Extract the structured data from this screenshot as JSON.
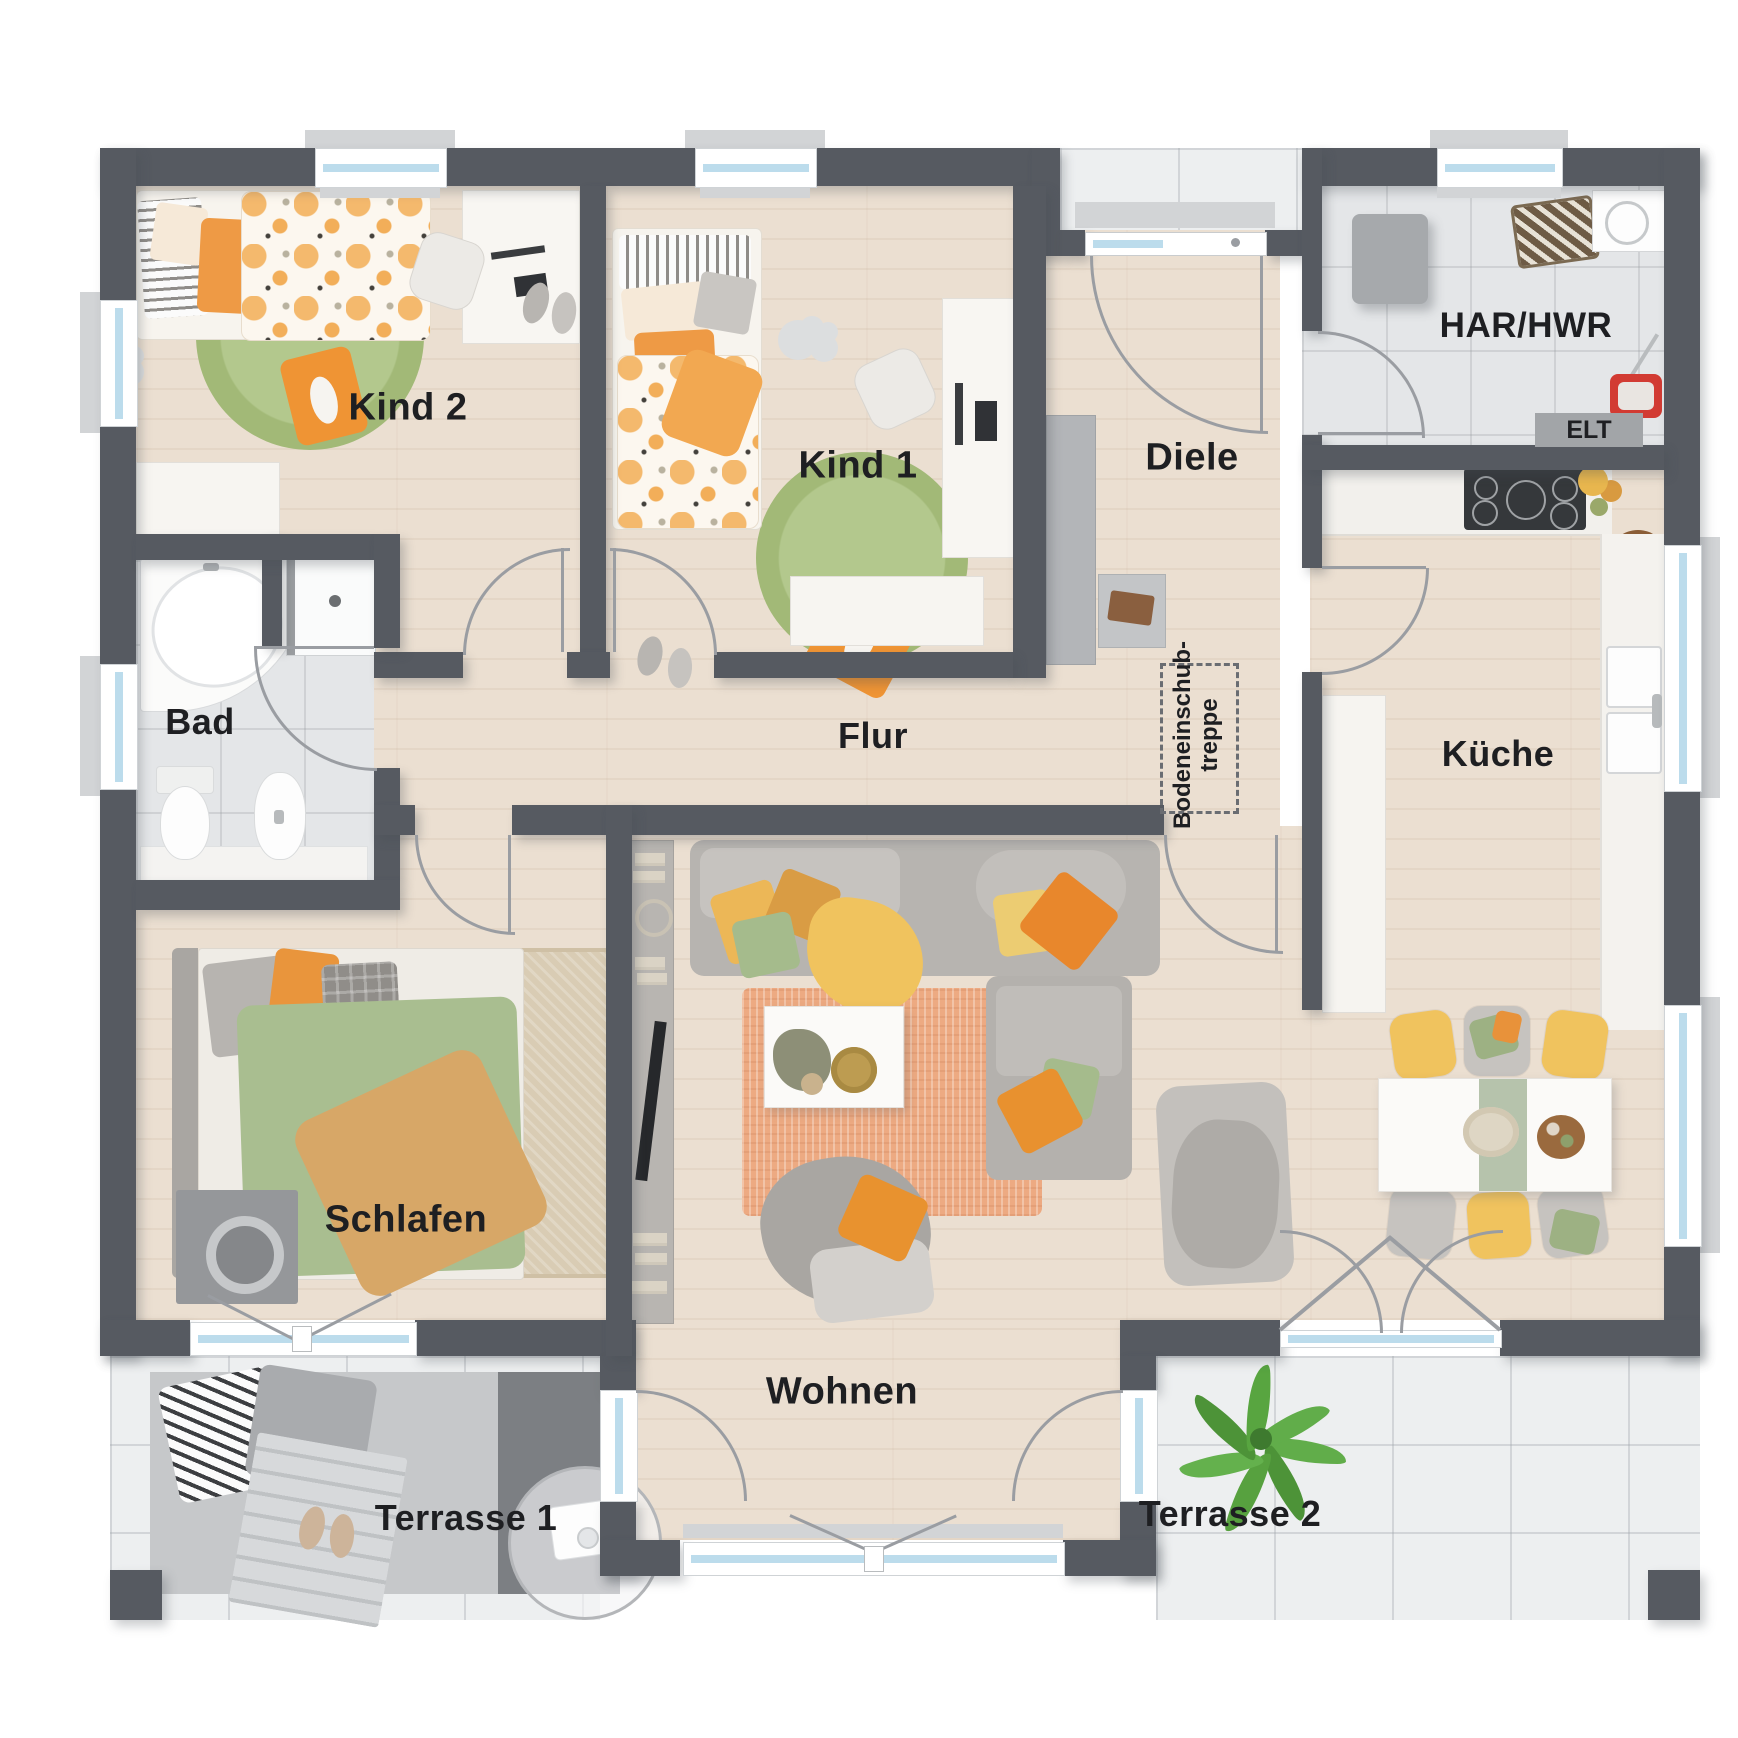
{
  "plan": {
    "type": "architectural floor plan, top-down 3D render",
    "labels": {
      "kind2": "Kind 2",
      "kind1": "Kind 1",
      "diele": "Diele",
      "har_hwr": "HAR/HWR",
      "elt": "ELT",
      "bad": "Bad",
      "flur": "Flur",
      "kueche": "Küche",
      "schlafen": "Schlafen",
      "wohnen": "Wohnen",
      "terrasse1": "Terrasse 1",
      "terrasse2": "Terrasse 2",
      "bodeneinschub_line1": "Bodeneinschub-",
      "bodeneinschub_line2": "treppe"
    },
    "palette": {
      "wall": "#565a61",
      "wood_floor": "#ebdfd1",
      "tile_floor": "#e4e6e8",
      "terrace_tile": "#edeff0",
      "window_glass": "#bcdcec",
      "accent_orange": "#e8912f",
      "accent_yellow": "#f0c35e",
      "accent_green": "#a5bb8c",
      "rug_salmon": "#edaa82",
      "rug_green": "#a8bd80"
    }
  }
}
